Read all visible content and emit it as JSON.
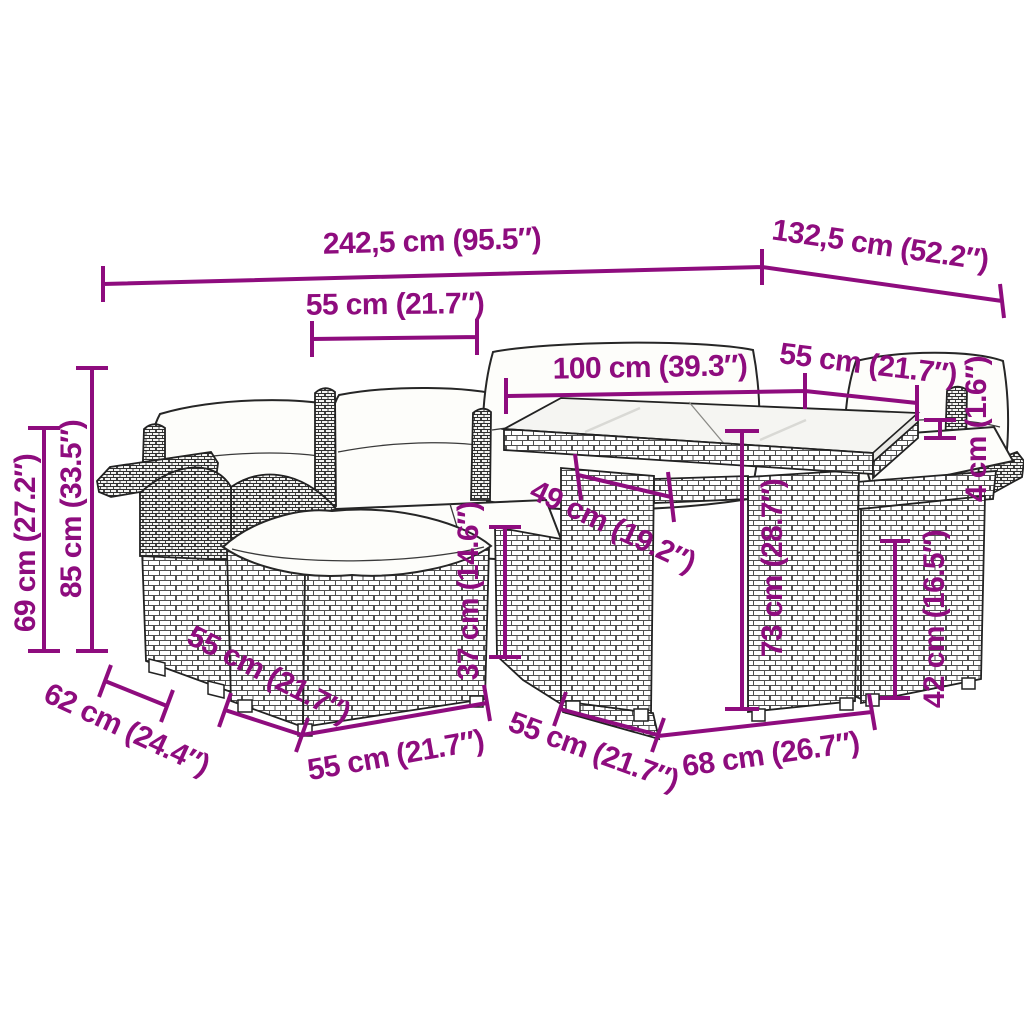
{
  "diagram": {
    "background": "#ffffff",
    "accent_color": "#8E0C7E",
    "subject": "garden-furniture-set-dimension-diagram"
  },
  "annotations": [
    {
      "name": "total-width",
      "label": "242,5 cm (95.5″)",
      "x": 432,
      "y": 243,
      "rot": -1.5
    },
    {
      "name": "total-depth",
      "label": "132,5 cm (52.2″)",
      "x": 880,
      "y": 247,
      "rot": 8.2
    },
    {
      "name": "backrest-width",
      "label": "55 cm (21.7″)",
      "x": 395,
      "y": 306,
      "rot": -0.5
    },
    {
      "name": "table-length",
      "label": "100 cm (39.3″)",
      "x": 650,
      "y": 369,
      "rot": -1
    },
    {
      "name": "table-width",
      "label": "55 cm (21.7″)",
      "x": 868,
      "y": 366,
      "rot": 7
    },
    {
      "name": "glass-thickness",
      "label": "4 cm (1.6″)",
      "x": 978,
      "y": 429,
      "rot": -90
    },
    {
      "name": "table-clearance",
      "label": "49 cm (19.2″)",
      "x": 612,
      "y": 528,
      "rot": 25
    },
    {
      "name": "seat-height",
      "label": "37 cm (14.6″)",
      "x": 470,
      "y": 591,
      "rot": -90
    },
    {
      "name": "table-height",
      "label": "73 cm (28.7″)",
      "x": 774,
      "y": 568,
      "rot": -90
    },
    {
      "name": "base-height",
      "label": "42 cm (16.5″)",
      "x": 936,
      "y": 619,
      "rot": -90
    },
    {
      "name": "arm-height",
      "label": "69 cm (27.2″)",
      "x": 27,
      "y": 543,
      "rot": -90
    },
    {
      "name": "back-height",
      "label": "85 cm (33.5″)",
      "x": 73,
      "y": 509,
      "rot": -90
    },
    {
      "name": "armrest-depth",
      "label": "62 cm (24.4″)",
      "x": 126,
      "y": 731,
      "rot": 25
    },
    {
      "name": "ottoman-depth",
      "label": "55 cm (21.7″)",
      "x": 268,
      "y": 676,
      "rot": 27
    },
    {
      "name": "seat-width-front",
      "label": "55 cm (21.7″)",
      "x": 396,
      "y": 757,
      "rot": -10
    },
    {
      "name": "chair-base-depth",
      "label": "55 cm (21.7″)",
      "x": 593,
      "y": 753,
      "rot": 20
    },
    {
      "name": "table-base-width",
      "label": "68 cm (26.7″)",
      "x": 771,
      "y": 756,
      "rot": -8
    }
  ]
}
